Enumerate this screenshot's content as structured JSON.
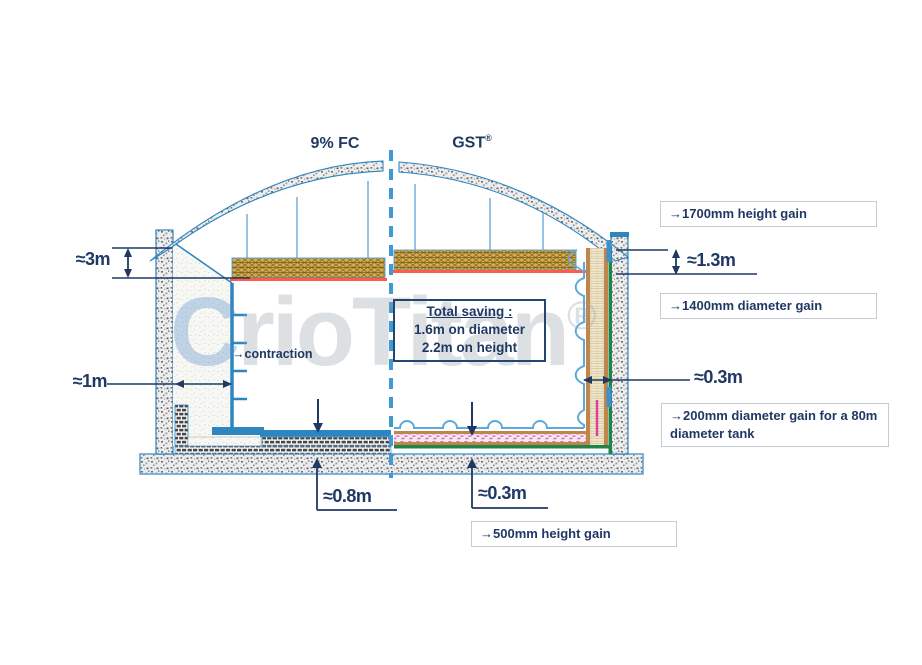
{
  "title_labels": {
    "fc": "9% FC",
    "gst": "GST",
    "gst_sup": "®"
  },
  "watermark": {
    "first_letter": "C",
    "rest": "rioTitan",
    "sup": "®"
  },
  "dimensions": {
    "wall_top_height": "≈3m",
    "wall_insulation_width": "≈1m",
    "gst_top_height": "≈1.3m",
    "gst_wall_width": "≈0.3m",
    "fc_base_height": "≈0.8m",
    "gst_base_height": "≈0.3m"
  },
  "callouts": {
    "contraction": "→contraction",
    "height_gain_1700": "→1700mm height gain",
    "diameter_gain_1400": "→1400mm diameter gain",
    "diameter_gain_200": "→200mm diameter gain for a 80m diameter tank",
    "height_gain_500": "→500mm height gain"
  },
  "total_saving": {
    "title": "Total saving :",
    "line1": "1.6m on diameter",
    "line2": "2.2m on height"
  },
  "colors": {
    "navy": "#1F3864",
    "structure_blue": "#2E86C1",
    "light_blue": "#5DA9DC",
    "dashed_blue": "#3D9BD4",
    "green": "#1E8449",
    "red": "#FF5B4A",
    "pink": "#E0409A",
    "deck_tan": "#D3AC52"
  }
}
